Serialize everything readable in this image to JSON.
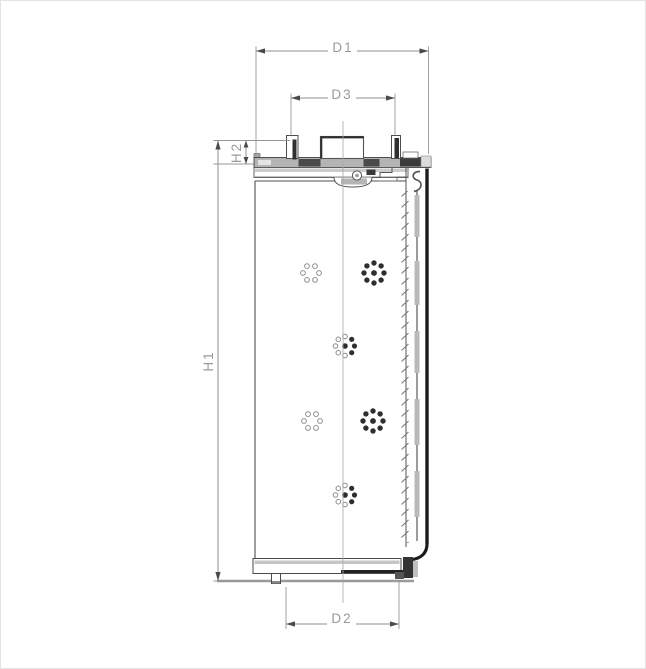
{
  "drawing": {
    "dimensions": {
      "d1": "D1",
      "d3": "D3",
      "h1": "H1",
      "h2": "H2",
      "d2": "D2"
    },
    "colors": {
      "dimension_lines": "#8f8f8f",
      "dimension_text": "#9a9a9a",
      "body_outline": "#4f4f4f",
      "outer_shell": "#1b1b1b",
      "plate_fill": "#b4b4b4",
      "dark_fill": "#3c3c3c",
      "perforation_dark": "#2e2e2e",
      "perforation_light": "#8e8e8e"
    }
  }
}
